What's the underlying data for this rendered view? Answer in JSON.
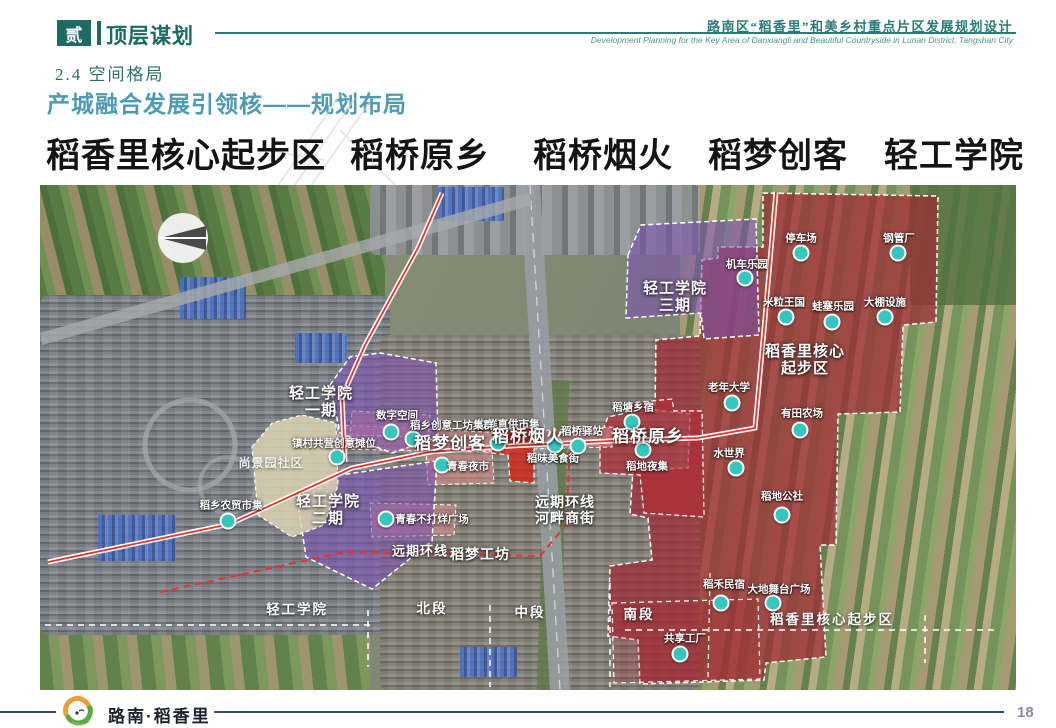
{
  "header": {
    "section_number": "贰",
    "section_title": "顶层谋划",
    "doc_title_cn": "路南区“稻香里”和美乡村重点片区发展规划设计",
    "doc_title_en": "Development Planning for the Key Area of Daoxiangli and Beautiful Countryside in Lunan District, Tangshan City"
  },
  "subsection": {
    "number_title": "2.4 空间格局",
    "heading": "产城融合发展引领核——规划布局"
  },
  "zone_titles": [
    "稻香里核心起步区",
    "稻桥原乡",
    "稻桥烟火",
    "稻梦创客",
    "轻工学院"
  ],
  "map": {
    "markers": [
      {
        "label": "停车场",
        "x": 761,
        "y": 68,
        "lx": 761,
        "ly": 53
      },
      {
        "label": "机车乐园",
        "x": 705,
        "y": 93,
        "lx": 707,
        "ly": 79
      },
      {
        "label": "钢管厂",
        "x": 858,
        "y": 68,
        "lx": 859,
        "ly": 53
      },
      {
        "label": "米粒王国",
        "x": 746,
        "y": 132,
        "lx": 744,
        "ly": 117
      },
      {
        "label": "蛙塞乐园",
        "x": 792,
        "y": 137,
        "lx": 793,
        "ly": 121
      },
      {
        "label": "大棚设施",
        "x": 845,
        "y": 132,
        "lx": 845,
        "ly": 117
      },
      {
        "label": "老年大学",
        "x": 692,
        "y": 218,
        "lx": 689,
        "ly": 202
      },
      {
        "label": "有田农场",
        "x": 760,
        "y": 245,
        "lx": 762,
        "ly": 228
      },
      {
        "label": "水世界",
        "x": 696,
        "y": 283,
        "lx": 689,
        "ly": 268
      },
      {
        "label": "稻地公社",
        "x": 742,
        "y": 330,
        "lx": 742,
        "ly": 311
      },
      {
        "label": "稻禾民宿",
        "x": 681,
        "y": 418,
        "lx": 684,
        "ly": 399
      },
      {
        "label": "大地舞台广场",
        "x": 733,
        "y": 418,
        "lx": 739,
        "ly": 404
      },
      {
        "label": "共享工厂",
        "x": 640,
        "y": 469,
        "lx": 645,
        "ly": 453
      },
      {
        "label": "稻塘乡宿",
        "x": 592,
        "y": 237,
        "lx": 593,
        "ly": 222
      },
      {
        "label": "稻地夜集",
        "x": 603,
        "y": 265,
        "lx": 607,
        "ly": 281
      },
      {
        "label": "生鲜直供市集",
        "x": 458,
        "y": 258,
        "lx": 468,
        "ly": 239
      },
      {
        "label": "稻味美食街",
        "x": 515,
        "y": 260,
        "lx": 513,
        "ly": 273
      },
      {
        "label": "稻桥驿站",
        "x": 538,
        "y": 261,
        "lx": 542,
        "ly": 246
      },
      {
        "label": "数字空间",
        "x": 351,
        "y": 247,
        "lx": 357,
        "ly": 230
      },
      {
        "label": "稻乡创意工坊集群",
        "x": 373,
        "y": 254,
        "lx": 412,
        "ly": 240
      },
      {
        "label": "镇村共营创意摊位",
        "x": 297,
        "y": 272,
        "lx": 294,
        "ly": 258
      },
      {
        "label": "青春夜市",
        "x": 402,
        "y": 280,
        "lx": 428,
        "ly": 281
      },
      {
        "label": "稻乡农贸市集",
        "x": 188,
        "y": 336,
        "lx": 191,
        "ly": 320
      },
      {
        "label": "青春不打烊广场",
        "x": 346,
        "y": 334,
        "lx": 392,
        "ly": 334
      }
    ],
    "zone_labels": [
      {
        "text": "轻工学院\n三期",
        "x": 635,
        "y": 112,
        "size": 15
      },
      {
        "text": "轻工学院\n一期",
        "x": 281,
        "y": 217,
        "size": 15
      },
      {
        "text": "轻工学院\n二期",
        "x": 288,
        "y": 325,
        "size": 15
      },
      {
        "text": "尚景园社区",
        "x": 231,
        "y": 279,
        "size": 12,
        "muted": true
      },
      {
        "text": "稻梦创客",
        "x": 410,
        "y": 259,
        "size": 17
      },
      {
        "text": "稻桥烟火",
        "x": 488,
        "y": 252,
        "size": 17
      },
      {
        "text": "稻桥原乡",
        "x": 608,
        "y": 252,
        "size": 17
      },
      {
        "text": "稻香里核心\n起步区",
        "x": 765,
        "y": 175,
        "size": 15
      },
      {
        "text": "远期环线\n河畔商街",
        "x": 525,
        "y": 325,
        "size": 14
      },
      {
        "text": "稻梦工坊",
        "x": 440,
        "y": 369,
        "size": 14
      },
      {
        "text": "远期环线",
        "x": 380,
        "y": 367,
        "size": 13
      }
    ],
    "section_labels": [
      {
        "text": "轻工学院",
        "x": 257,
        "y": 423
      },
      {
        "text": "北段",
        "x": 392,
        "y": 422
      },
      {
        "text": "中段",
        "x": 490,
        "y": 426
      },
      {
        "text": "南段",
        "x": 599,
        "y": 428
      },
      {
        "text": "稻香里核心起步区",
        "x": 792,
        "y": 433
      }
    ]
  },
  "footer": {
    "logo_text": "路南·稻香里",
    "page_number": "18"
  },
  "colors": {
    "accent_teal": "#1d6b64",
    "heading_blue": "#4c9ab3",
    "marker_teal": "#35c6bd",
    "zone_purple": "#7b4fb5",
    "zone_red": "#9e2a33",
    "corridor_pink": "#e28c8c",
    "footer_line": "#3a447f"
  }
}
